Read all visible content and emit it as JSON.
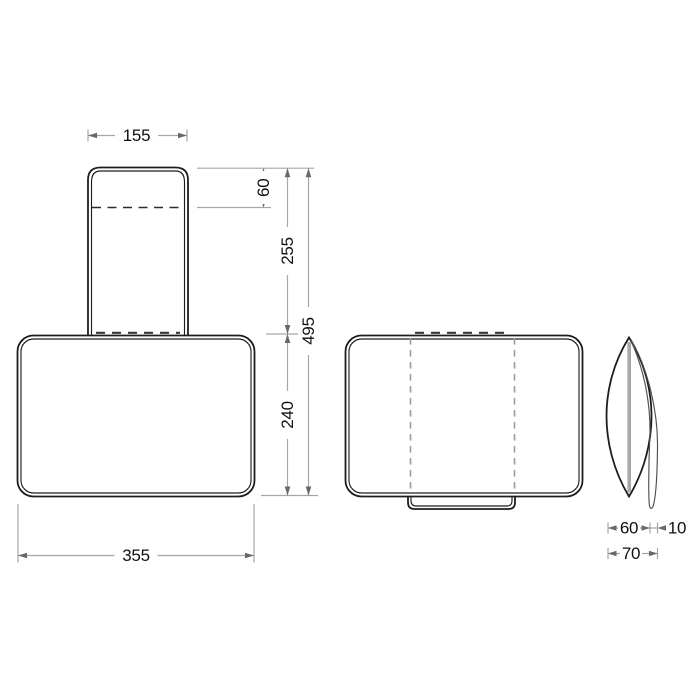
{
  "dimensions": {
    "front": {
      "strap_width": "155",
      "strap_exposed_height": "60",
      "strap_length": "255",
      "overall_height": "495",
      "body_height": "240",
      "body_width": "355"
    },
    "side": {
      "body_depth": "60",
      "strap_offset": "10",
      "overall_depth": "70"
    }
  },
  "colors": {
    "outline": "#1d1d1d",
    "dimension_line": "#a6a6a6",
    "arrowhead": "#686868",
    "hidden_line_gray": "#9a9a9a",
    "hidden_line_dark": "#2c2c2c",
    "text": "#101010",
    "background": "#ffffff"
  }
}
